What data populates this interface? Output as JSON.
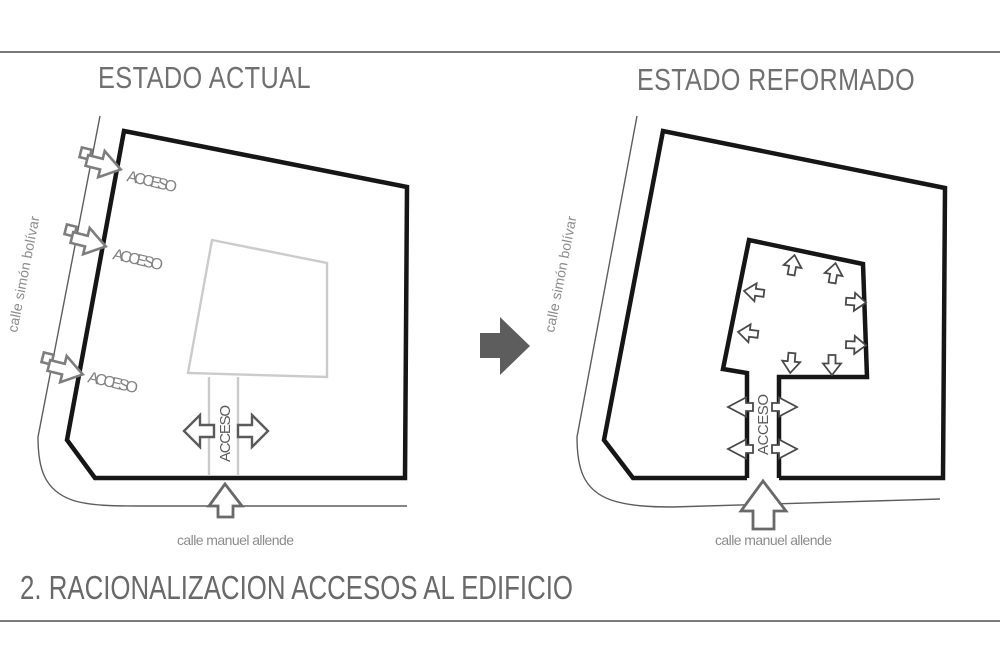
{
  "left_diagram": {
    "title": "ESTADO ACTUAL",
    "street_side": "calle simón bolívar",
    "street_bottom": "calle manuel allende",
    "access_labels": [
      "ACCESO",
      "ACCESO",
      "ACCESO"
    ],
    "corridor_label": "ACCESO"
  },
  "right_diagram": {
    "title": "ESTADO REFORMADO",
    "street_side": "calle simón bolívar",
    "street_bottom": "calle manuel allende",
    "corridor_label": "ACCESO"
  },
  "footer": {
    "section_title": "2. RACIONALIZACION ACCESOS AL EDIFICIO"
  },
  "colors": {
    "outline": "#161616",
    "street_line": "#5d5d5d",
    "building_gray": "#cbcbcb",
    "title_gray": "#707070",
    "transform_arrow": "#5d5d5d"
  }
}
